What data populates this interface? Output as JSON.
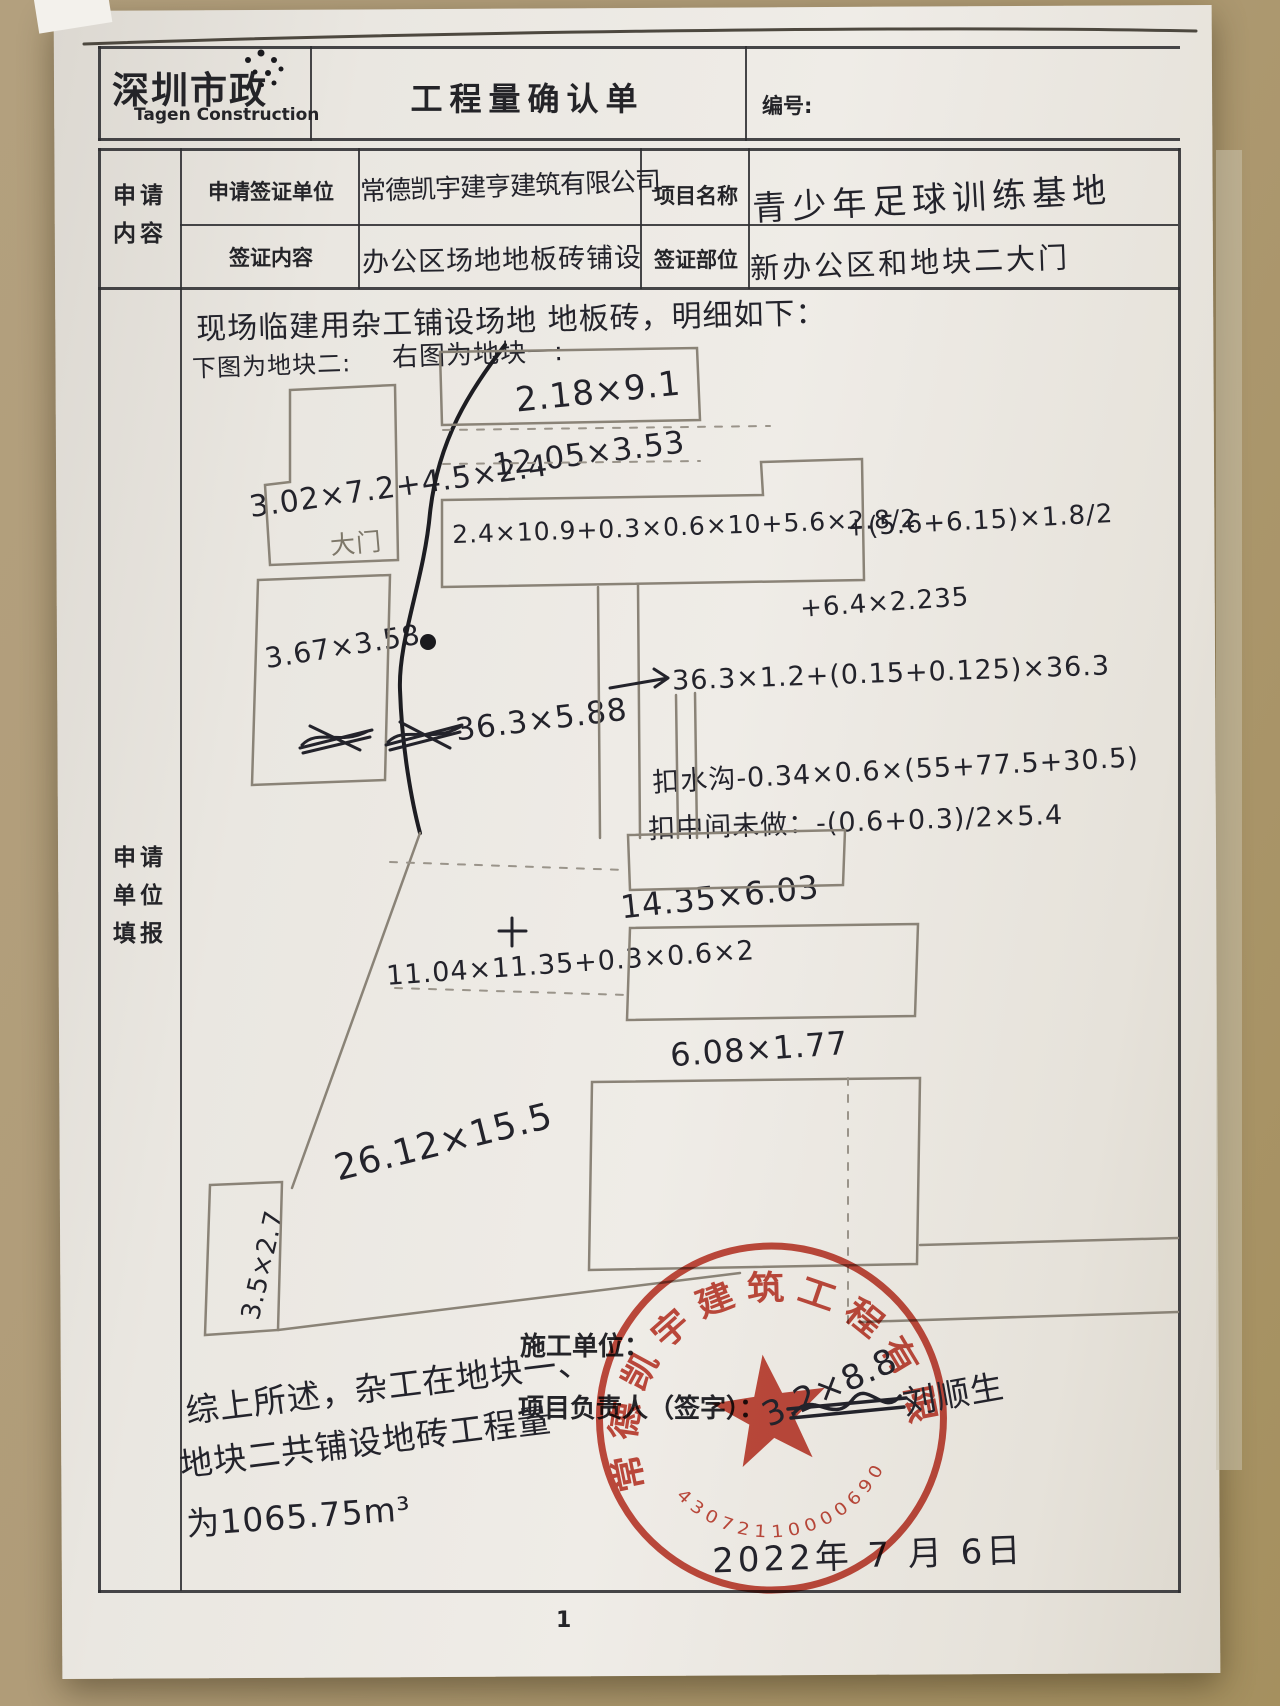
{
  "header": {
    "logo_cn": "深圳市政",
    "logo_en": "Tagen Construction",
    "title": "工程量确认单",
    "number_label": "编号:"
  },
  "form": {
    "section_l1": "申请",
    "section_l2": "内容",
    "fill_l1": "申请",
    "fill_l2": "单位",
    "fill_l3": "填报",
    "apply_unit_label": "申请签证单位",
    "apply_unit_value": "常德凯宇建亨建筑有限公司",
    "project_name_label": "项目名称",
    "project_name_value": "青少年足球训练基地",
    "visa_content_label": "签证内容",
    "visa_content_value": "办公区场地地板砖铺设",
    "visa_part_label": "签证部位",
    "visa_part_value": "新办公区和地块二大门"
  },
  "notes": {
    "intro": "现场临建用杂工铺设场地 地板砖，明细如下：",
    "left_caption": "下图为地块二:",
    "right_caption": "右图为地块一:",
    "gate": "大门"
  },
  "sketch": {
    "labels": {
      "a1": "2.18×9.1",
      "a2": "12.05×3.53",
      "a3": "3.02×7.2+4.5×2.4",
      "a4": "2.4×10.9+0.3×0.6×10+5.6×2.8/2",
      "a5": "+(5.6+6.15)×1.8/2",
      "a6": "+6.4×2.235",
      "a7": "3.67×3.58",
      "a8": "36.3×5.88",
      "a9": "36.3×1.2+(0.15+0.125)×36.3",
      "a10": "扣水沟-0.34×0.6×(55+77.5+30.5)",
      "a11": "扣中间未做：-(0.6+0.3)/2×5.4",
      "a12": "14.35×6.03",
      "a13": "11.04×11.35+0.3×0.6×2",
      "a14": "6.08×1.77",
      "a15": "26.12×15.5",
      "a16": "3.5×2.7",
      "a17": "3.2×8.8"
    }
  },
  "summary": {
    "l1": "综上所述，杂工在地块一、",
    "l2": "地块二共铺设地砖工程量",
    "l3": "为1065.75m³"
  },
  "footer": {
    "constructor_label": "施工单位：",
    "manager_label": "项目负责人（签字）：",
    "signature": "刘顺生",
    "date": "2022年 7 月 6日",
    "page": "1"
  },
  "stamp": {
    "company": "常德凯宇建筑工程有限公司",
    "serial": "43072110000690"
  },
  "colors": {
    "paper": "#eae7e1",
    "desk": "#b09c78",
    "ink": "#23232b",
    "pencil": "#8a8377",
    "stamp_red": "#c0392b"
  }
}
